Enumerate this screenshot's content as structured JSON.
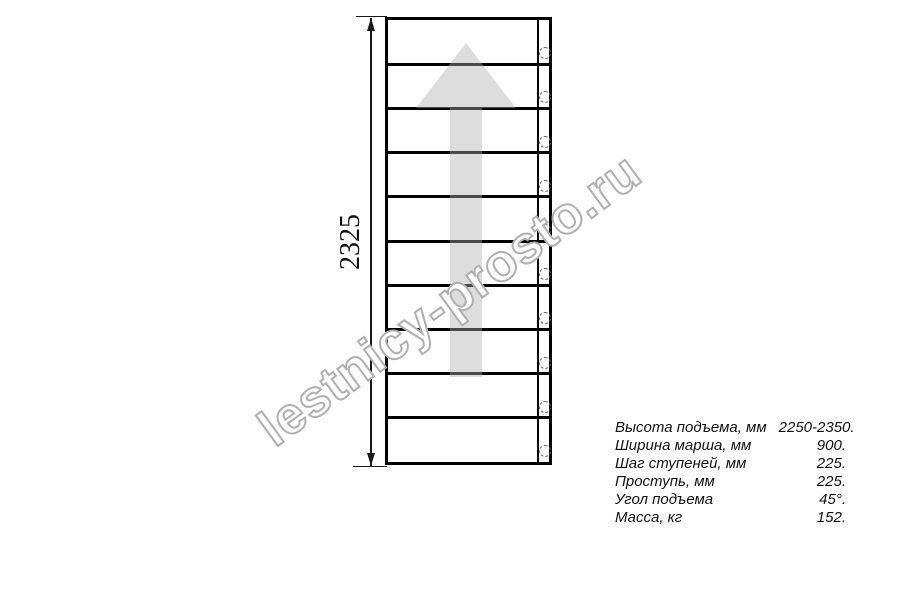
{
  "drawing": {
    "type": "staircase-plan-top-view",
    "dimension_label": "2325",
    "stairs": {
      "step_count": 10,
      "bolt_count": 10
    },
    "direction_arrow": "up"
  },
  "watermark": {
    "text": "lestnicy-prosto.ru"
  },
  "specs": {
    "rows": [
      {
        "label": "Высота подъема, мм",
        "value": "2250-2350."
      },
      {
        "label": "Ширина марша, мм",
        "value": "900."
      },
      {
        "label": "Шаг ступеней, мм",
        "value": "225."
      },
      {
        "label": "Проступь, мм",
        "value": "225."
      },
      {
        "label": "Угол подъема",
        "value": "45°."
      },
      {
        "label": "Масса, кг",
        "value": "152."
      }
    ]
  },
  "colors": {
    "line": "#000000",
    "dimension_line": "#1a1a1a",
    "arrow_fill": "rgba(175,175,175,0.42)",
    "watermark_outline": "#b0b0b0",
    "text": "#111111",
    "background": "#ffffff"
  }
}
